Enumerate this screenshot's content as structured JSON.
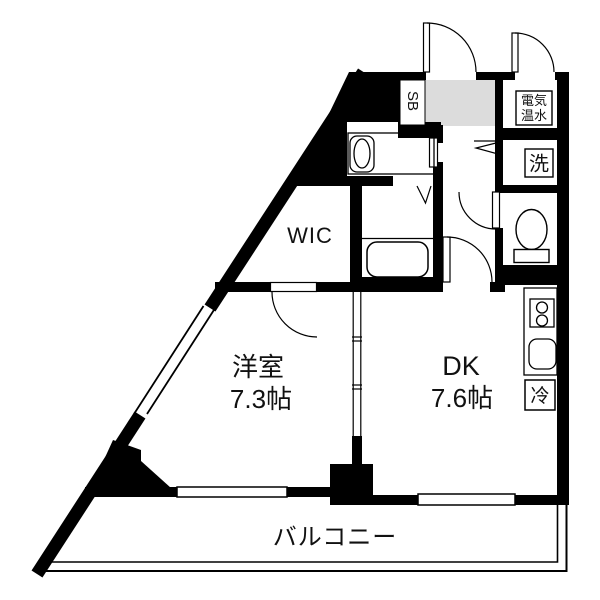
{
  "rooms": {
    "western": {
      "name": "洋室",
      "size": "7.3帖"
    },
    "dining_kitchen": {
      "name": "DK",
      "size": "7.6帖"
    },
    "wic": {
      "label": "WIC"
    },
    "balcony": {
      "label": "バルコニー"
    },
    "shoe_box": {
      "label": "SB"
    }
  },
  "fixtures": {
    "water_heater": {
      "line1": "電気",
      "line2": "温水"
    },
    "washer": {
      "label": "洗"
    },
    "fridge": {
      "label": "冷"
    }
  },
  "colors": {
    "wall": "#000000",
    "entry_floor": "#dcdcdc",
    "background": "#ffffff"
  }
}
